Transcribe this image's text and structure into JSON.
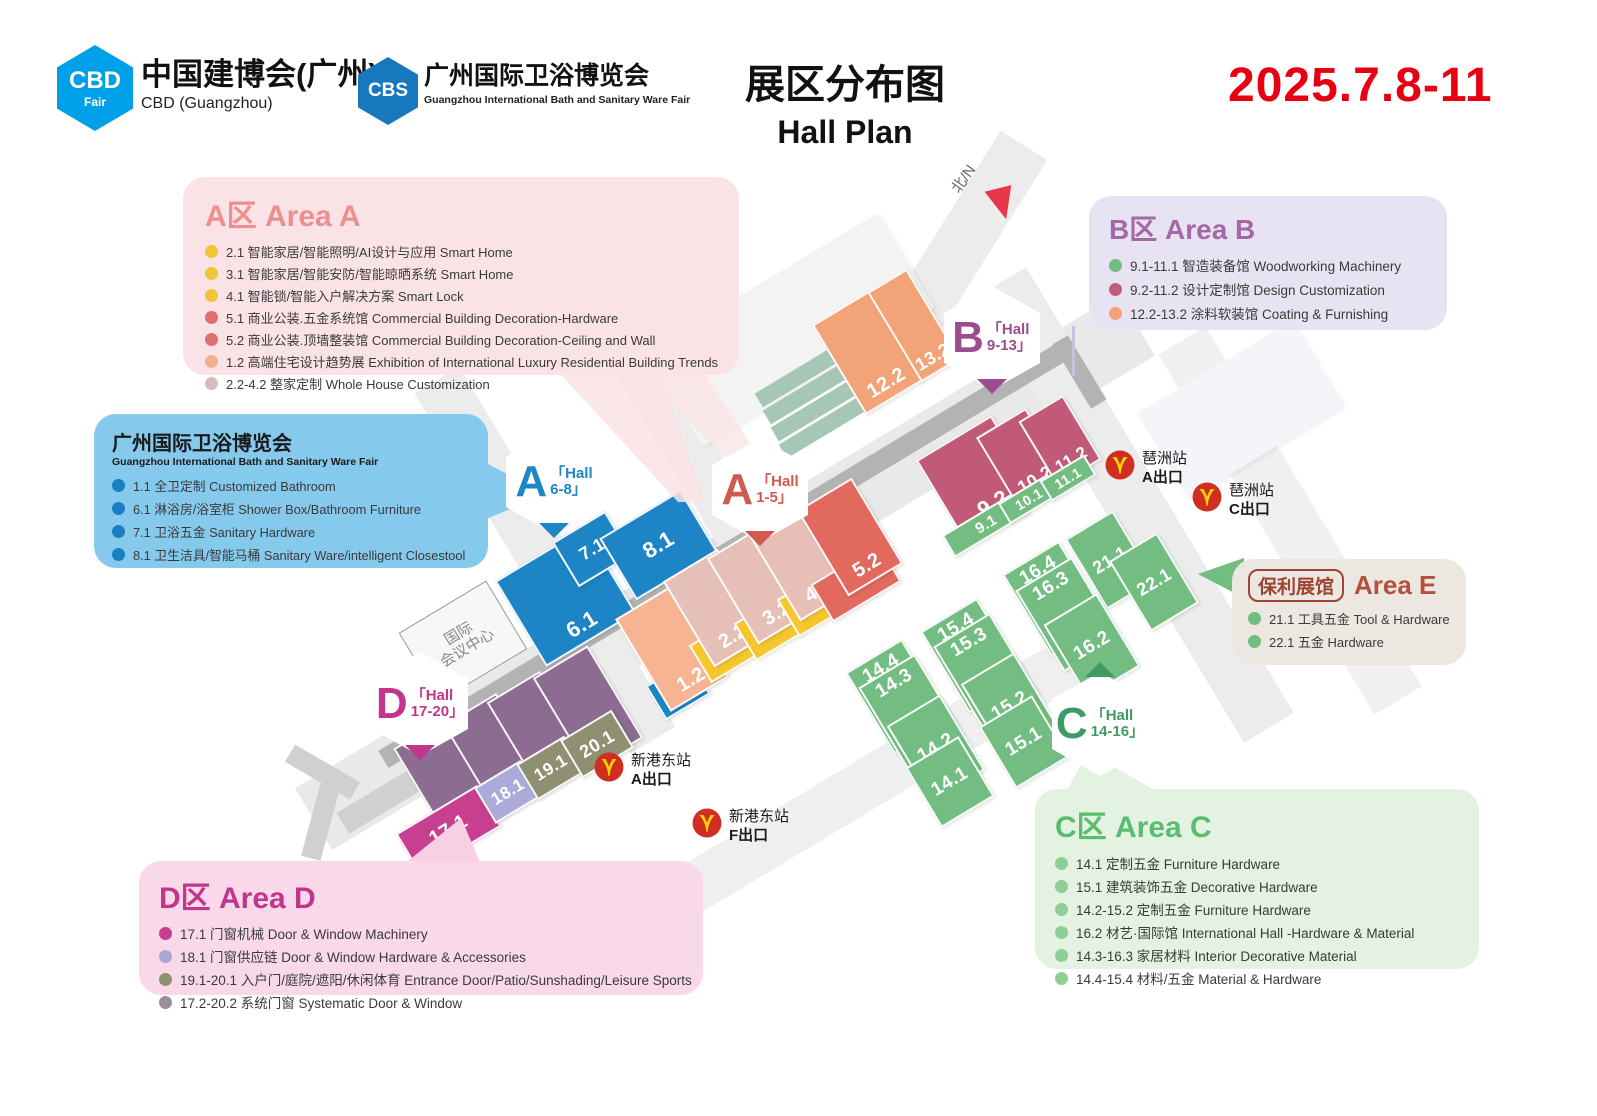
{
  "header": {
    "cbd_logo_text": "CBD",
    "cbd_logo_sub": "Fair",
    "cbd_title": "中国建博会(广州)",
    "cbd_subtitle": "CBD (Guangzhou)",
    "cbs_logo_text": "CBS",
    "cbs_title": "广州国际卫浴博览会",
    "cbs_subtitle": "Guangzhou International Bath and Sanitary Ware Fair",
    "title_cn": "展区分布图",
    "title_en": "Hall Plan",
    "date": "2025.7.8-11",
    "date_color": "#e60012"
  },
  "legends": {
    "area_a": {
      "title": "A区 Area A",
      "title_color": "#ee8f8f",
      "bg": "#fae3e6",
      "items": [
        {
          "dot": "#f0c53a",
          "text": "2.1 智能家居/智能照明/AI设计与应用 Smart Home"
        },
        {
          "dot": "#f0c53a",
          "text": "3.1 智能家居/智能安防/智能晾晒系统 Smart Home"
        },
        {
          "dot": "#f0c53a",
          "text": "4.1 智能锁/智能入户解决方案 Smart Lock"
        },
        {
          "dot": "#dd6f6f",
          "text": "5.1 商业公装.五金系统馆 Commercial Building Decoration-Hardware"
        },
        {
          "dot": "#dd6f6f",
          "text": "5.2 商业公装.顶墙整装馆 Commercial Building Decoration-Ceiling and Wall"
        },
        {
          "dot": "#f2b093",
          "text": "1.2 高端住宅设计趋势展 Exhibition of International Luxury Residential Building Trends"
        },
        {
          "dot": "#d8bcbc",
          "text": "2.2-4.2 整家定制 Whole House Customization"
        }
      ]
    },
    "bath": {
      "title": "广州国际卫浴博览会",
      "subtitle": "Guangzhou International Bath and Sanitary Ware Fair",
      "bg": "#85c9ec",
      "items": [
        {
          "dot": "#1a7fc0",
          "text": "1.1 全卫定制 Customized Bathroom"
        },
        {
          "dot": "#1a7fc0",
          "text": "6.1 淋浴房/浴室柜 Shower Box/Bathroom Furniture"
        },
        {
          "dot": "#1a7fc0",
          "text": "7.1 卫浴五金 Sanitary Hardware"
        },
        {
          "dot": "#1a7fc0",
          "text": "8.1 卫生洁具/智能马桶 Sanitary Ware/intelligent Closestool"
        }
      ]
    },
    "area_b": {
      "title": "B区 Area B",
      "title_color": "#a468a8",
      "bg": "#e8e3f2",
      "items": [
        {
          "dot": "#72bd80",
          "text": "9.1-11.1 智造装备馆 Woodworking Machinery"
        },
        {
          "dot": "#c25c7c",
          "text": "9.2-11.2 设计定制馆 Design Customization"
        },
        {
          "dot": "#f2a276",
          "text": "12.2-13.2 涂料软装馆 Coating & Furnishing"
        }
      ]
    },
    "area_e": {
      "badge_label": "保利展馆",
      "title": "Area E",
      "title_color": "#b5503c",
      "bg": "#ece7e0",
      "items": [
        {
          "dot": "#72bd80",
          "text": "21.1 工具五金 Tool & Hardware"
        },
        {
          "dot": "#72bd80",
          "text": "22.1 五金 Hardware"
        }
      ]
    },
    "area_c": {
      "title": "C区 Area C",
      "title_color": "#5abc6e",
      "bg": "#e4f2e2",
      "items": [
        {
          "dot": "#8fcf96",
          "text": "14.1 定制五金 Furniture Hardware"
        },
        {
          "dot": "#8fcf96",
          "text": "15.1 建筑装饰五金 Decorative Hardware"
        },
        {
          "dot": "#8fcf96",
          "text": "14.2-15.2 定制五金 Furniture Hardware"
        },
        {
          "dot": "#8fcf96",
          "text": "16.2 材艺·国际馆 International Hall -Hardware & Material"
        },
        {
          "dot": "#8fcf96",
          "text": "14.3-16.3 家居材料 Interior Decorative Material"
        },
        {
          "dot": "#8fcf96",
          "text": "14.4-15.4 材料/五金 Material & Hardware"
        }
      ]
    },
    "area_d": {
      "title": "D区 Area D",
      "title_color": "#c2358c",
      "bg": "#f9d9e9",
      "items": [
        {
          "dot": "#c73e8e",
          "text": "17.1 门窗机械  Door & Window Machinery"
        },
        {
          "dot": "#a9a7d6",
          "text": "18.1 门窗供应链  Door & Window Hardware & Accessories"
        },
        {
          "dot": "#8f8f73",
          "text": "19.1-20.1 入户门/庭院/遮阳/休闲体育 Entrance Door/Patio/Sunshading/Leisure Sports"
        },
        {
          "dot": "#9d8d9d",
          "text": "17.2-20.2 系统门窗 Systematic Door & Window"
        }
      ]
    }
  },
  "colors": {
    "blue": "#1d84c5",
    "peach": "#f6b493",
    "rose": "#e6c0b7",
    "yellow": "#f5c62e",
    "red": "#e2695e",
    "orange": "#f2a478",
    "maroon": "#c15a78",
    "green": "#74bd82",
    "purple": "#8c6c91",
    "lavender": "#abaad8",
    "olive": "#8f8f72",
    "magenta": "#c83f90"
  },
  "map": {
    "north": {
      "label": "北/N"
    },
    "convention": {
      "line1": "国际",
      "line2": "会议中心"
    },
    "badges": [
      {
        "letter": "A",
        "line1": "「Hall",
        "line2": "6-8」",
        "color": "#1f86c6",
        "x": 506,
        "y": 430,
        "pointer": "down"
      },
      {
        "letter": "A",
        "line1": "「Hall",
        "line2": "1-5」",
        "color": "#cf5a50",
        "x": 712,
        "y": 438,
        "pointer": "down"
      },
      {
        "letter": "B",
        "line1": "「Hall",
        "line2": "9-13」",
        "color": "#9b4d8f",
        "x": 944,
        "y": 286,
        "pointer": "down"
      },
      {
        "letter": "C",
        "line1": "「Hall",
        "line2": "14-16」",
        "color": "#3f9b66",
        "x": 1052,
        "y": 672,
        "pointer": "up"
      },
      {
        "letter": "D",
        "line1": "「Hall",
        "line2": "17-20」",
        "color": "#c2358c",
        "x": 372,
        "y": 652,
        "pointer": "down"
      }
    ],
    "stations": [
      {
        "name": "琶洲站",
        "exit": "A出口",
        "x": 1105,
        "y": 450
      },
      {
        "name": "琶洲站",
        "exit": "C出口",
        "x": 1192,
        "y": 482
      },
      {
        "name": "新港东站",
        "exit": "A出口",
        "x": 594,
        "y": 752
      },
      {
        "name": "新港东站",
        "exit": "F出口",
        "x": 692,
        "y": 808
      }
    ],
    "halls": [
      {
        "label": "6.1",
        "color": "blue",
        "x": 565,
        "y": 597,
        "w": 105,
        "h": 100,
        "fs": 22,
        "lp": "b"
      },
      {
        "label": "7.1",
        "color": "blue",
        "x": 592,
        "y": 549,
        "w": 62,
        "h": 52,
        "fs": 18,
        "lp": "c"
      },
      {
        "label": "8.1",
        "color": "blue",
        "x": 658,
        "y": 545,
        "w": 95,
        "h": 72,
        "fs": 22,
        "lp": "c"
      },
      {
        "label": "1.1",
        "color": "blue",
        "x": 678,
        "y": 690,
        "w": 52,
        "h": 40,
        "fs": 16,
        "lp": "c"
      },
      {
        "label": "1.2",
        "color": "peach",
        "x": 672,
        "y": 648,
        "w": 68,
        "h": 108,
        "fs": 20,
        "lp": "b"
      },
      {
        "label": "2.1",
        "color": "yellow",
        "x": 724,
        "y": 650,
        "w": 56,
        "h": 44,
        "fs": 18,
        "lp": "c"
      },
      {
        "label": "2.2",
        "color": "rose",
        "x": 716,
        "y": 608,
        "w": 64,
        "h": 100,
        "fs": 20,
        "lp": "b"
      },
      {
        "label": "3.1",
        "color": "yellow",
        "x": 769,
        "y": 628,
        "w": 56,
        "h": 44,
        "fs": 18,
        "lp": "c"
      },
      {
        "label": "3.2",
        "color": "rose",
        "x": 760,
        "y": 585,
        "w": 64,
        "h": 100,
        "fs": 20,
        "lp": "b"
      },
      {
        "label": "4.1",
        "color": "yellow",
        "x": 812,
        "y": 604,
        "w": 56,
        "h": 44,
        "fs": 18,
        "lp": "c"
      },
      {
        "label": "4.2",
        "color": "rose",
        "x": 802,
        "y": 562,
        "w": 64,
        "h": 100,
        "fs": 20,
        "lp": "b"
      },
      {
        "label": "5.1",
        "color": "red",
        "x": 856,
        "y": 583,
        "w": 80,
        "h": 44,
        "fs": 18,
        "lp": "c"
      },
      {
        "label": "5.2",
        "color": "red",
        "x": 850,
        "y": 537,
        "w": 64,
        "h": 100,
        "fs": 20,
        "lp": "b"
      },
      {
        "label": "12.2",
        "color": "orange",
        "x": 868,
        "y": 352,
        "w": 68,
        "h": 105,
        "fs": 20,
        "lp": "b"
      },
      {
        "label": "13.2",
        "color": "orange",
        "x": 914,
        "y": 325,
        "w": 46,
        "h": 105,
        "fs": 18,
        "lp": "b"
      },
      {
        "label": "9.2",
        "color": "maroon",
        "x": 978,
        "y": 478,
        "w": 88,
        "h": 95,
        "fs": 22,
        "lp": "b"
      },
      {
        "label": "9.1",
        "color": "green",
        "x": 986,
        "y": 524,
        "w": 88,
        "h": 26,
        "fs": 15,
        "lp": "c"
      },
      {
        "label": "10.2",
        "color": "maroon",
        "x": 1022,
        "y": 458,
        "w": 58,
        "h": 82,
        "fs": 18,
        "lp": "b"
      },
      {
        "label": "10.1",
        "color": "green",
        "x": 1029,
        "y": 499,
        "w": 58,
        "h": 24,
        "fs": 14,
        "lp": "c"
      },
      {
        "label": "11.2",
        "color": "maroon",
        "x": 1060,
        "y": 440,
        "w": 52,
        "h": 75,
        "fs": 17,
        "lp": "b"
      },
      {
        "label": "11.1",
        "color": "green",
        "x": 1068,
        "y": 478,
        "w": 52,
        "h": 24,
        "fs": 14,
        "lp": "c"
      },
      {
        "label": "21.1",
        "color": "green",
        "x": 1110,
        "y": 560,
        "w": 56,
        "h": 82,
        "fs": 18,
        "lp": "c"
      },
      {
        "label": "22.1",
        "color": "green",
        "x": 1154,
        "y": 582,
        "w": 56,
        "h": 82,
        "fs": 18,
        "lp": "c"
      },
      {
        "label": "16.4",
        "color": "green",
        "x": 1055,
        "y": 598,
        "w": 66,
        "h": 95,
        "fs": 19,
        "lp": "t"
      },
      {
        "label": "16.3",
        "color": "green",
        "x": 1068,
        "y": 614,
        "w": 66,
        "h": 95,
        "fs": 19,
        "lp": "t",
        "z": 6
      },
      {
        "label": "16.2",
        "color": "green",
        "x": 1092,
        "y": 645,
        "w": 62,
        "h": 85,
        "fs": 19,
        "lp": "c",
        "z": 7
      },
      {
        "label": "15.4",
        "color": "green",
        "x": 973,
        "y": 655,
        "w": 66,
        "h": 95,
        "fs": 19,
        "lp": "t"
      },
      {
        "label": "15.3",
        "color": "green",
        "x": 986,
        "y": 670,
        "w": 66,
        "h": 95,
        "fs": 19,
        "lp": "t",
        "z": 6
      },
      {
        "label": "15.2",
        "color": "green",
        "x": 1010,
        "y": 706,
        "w": 62,
        "h": 88,
        "fs": 19,
        "lp": "c",
        "z": 7
      },
      {
        "label": "15.1",
        "color": "green",
        "x": 1024,
        "y": 742,
        "w": 62,
        "h": 72,
        "fs": 19,
        "lp": "c",
        "z": 8
      },
      {
        "label": "14.4",
        "color": "green",
        "x": 898,
        "y": 696,
        "w": 66,
        "h": 95,
        "fs": 19,
        "lp": "t"
      },
      {
        "label": "14.3",
        "color": "green",
        "x": 911,
        "y": 711,
        "w": 66,
        "h": 95,
        "fs": 19,
        "lp": "t",
        "z": 6
      },
      {
        "label": "14.2",
        "color": "green",
        "x": 936,
        "y": 748,
        "w": 62,
        "h": 88,
        "fs": 19,
        "lp": "c",
        "z": 7
      },
      {
        "label": "14.1",
        "color": "green",
        "x": 950,
        "y": 782,
        "w": 62,
        "h": 70,
        "fs": 19,
        "lp": "c",
        "z": 8
      },
      {
        "label": "17.2",
        "color": "purple",
        "x": 452,
        "y": 780,
        "w": 68,
        "h": 115,
        "fs": 20,
        "lp": "b"
      },
      {
        "label": "18.2",
        "color": "purple",
        "x": 498,
        "y": 756,
        "w": 62,
        "h": 110,
        "fs": 20,
        "lp": "b"
      },
      {
        "label": "19.2",
        "color": "purple",
        "x": 541,
        "y": 733,
        "w": 62,
        "h": 108,
        "fs": 20,
        "lp": "b"
      },
      {
        "label": "20.2",
        "color": "purple",
        "x": 588,
        "y": 708,
        "w": 64,
        "h": 108,
        "fs": 20,
        "lp": "b"
      },
      {
        "label": "17.1",
        "color": "magenta",
        "x": 448,
        "y": 830,
        "w": 95,
        "h": 48,
        "fs": 20,
        "lp": "c",
        "z": 6
      },
      {
        "label": "18.1",
        "color": "lavender",
        "x": 508,
        "y": 792,
        "w": 54,
        "h": 42,
        "fs": 17,
        "lp": "c",
        "z": 6
      },
      {
        "label": "19.1",
        "color": "olive",
        "x": 551,
        "y": 768,
        "w": 56,
        "h": 42,
        "fs": 17,
        "lp": "c",
        "z": 6
      },
      {
        "label": "20.1",
        "color": "olive",
        "x": 597,
        "y": 744,
        "w": 60,
        "h": 44,
        "fs": 18,
        "lp": "c",
        "z": 6
      }
    ]
  }
}
